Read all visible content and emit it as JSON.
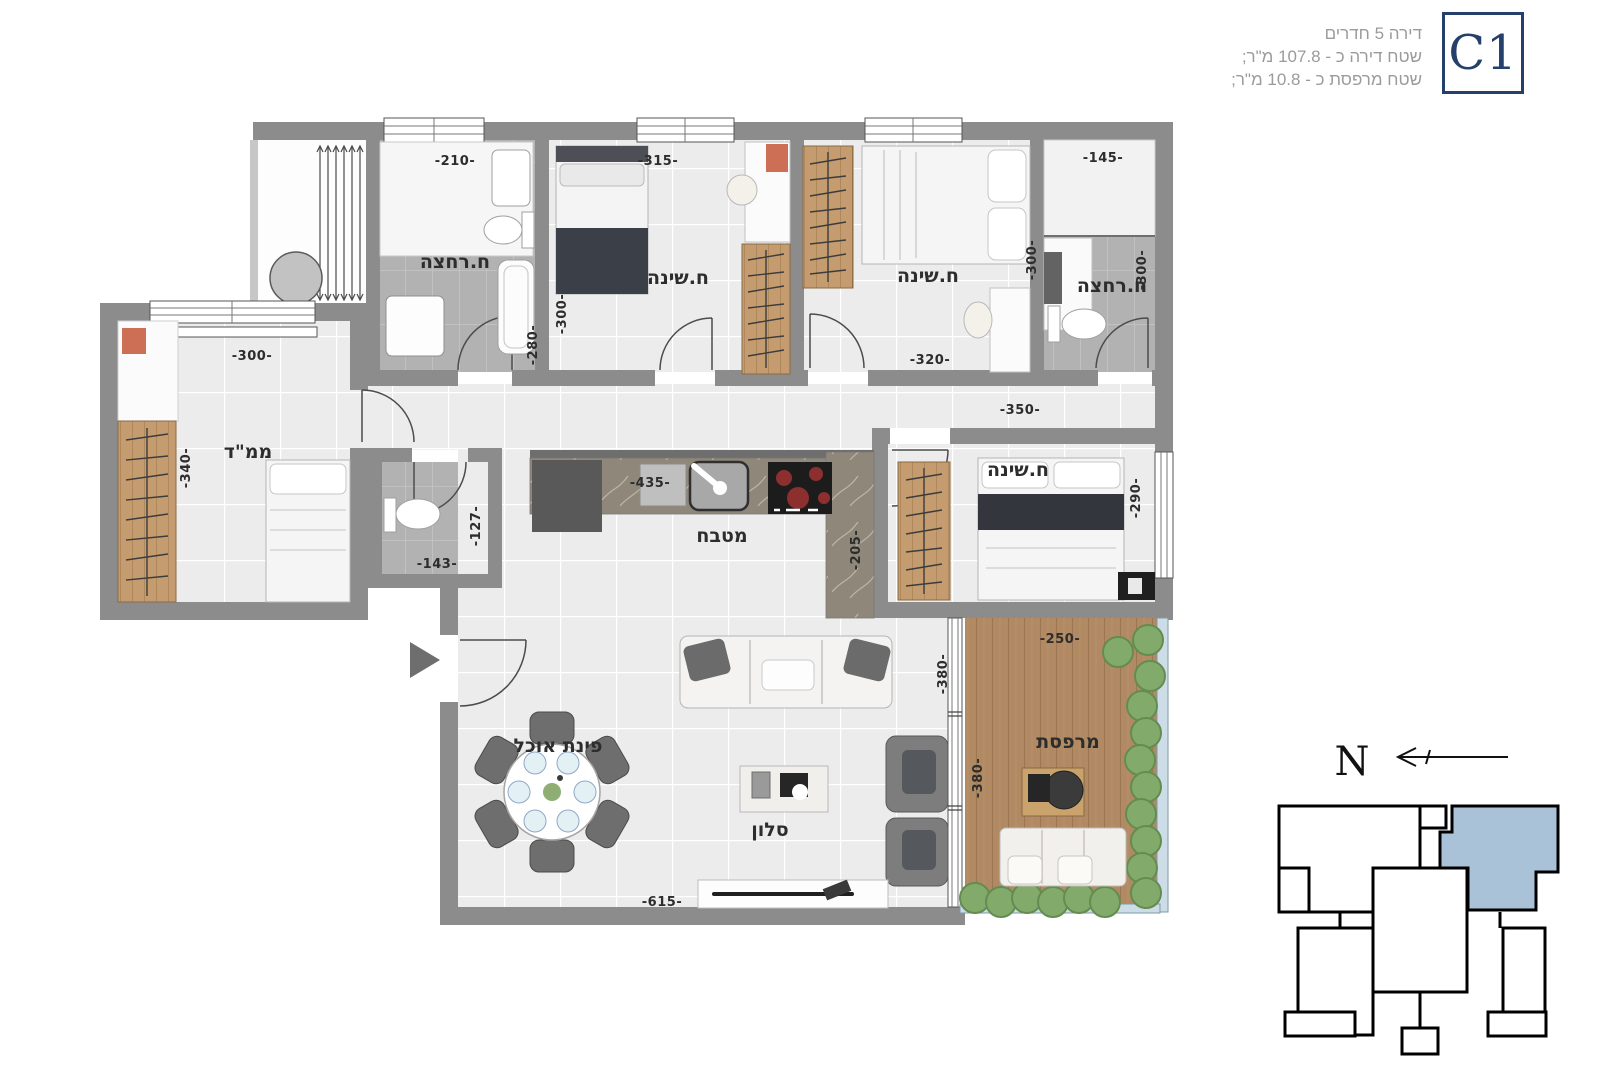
{
  "header": {
    "line1": "דירה 5 חדרים",
    "line2": "שטח דירה כ - 107.8 מ\"ר;",
    "line3": "שטח מרפסת כ - 10.8 מ\"ר;",
    "unit_code": "C1"
  },
  "rooms": {
    "bathroom_top_left": {
      "label": "ח.רחצה",
      "dim_width": "-210-",
      "dim_niche": "-280-"
    },
    "bedroom_top_1": {
      "label": "ח.שינה",
      "dim_width": "-315-",
      "dim_depth": "-300-"
    },
    "bedroom_top_2": {
      "label": "ח.שינה",
      "dim_width": "-320-",
      "dim_depth": "-300-"
    },
    "bathroom_top_right": {
      "label": "ח.רחצה",
      "dim_width": "-145-",
      "dim_depth": "-300-"
    },
    "mamad": {
      "label": "ממ\"ד",
      "dim_width": "-300-",
      "dim_depth": "-340-"
    },
    "wc": {
      "dim_width": "-143-",
      "dim_depth": "-127-"
    },
    "kitchen": {
      "label": "מטבח",
      "dim_width": "-435-",
      "dim_peninsula": "-205-"
    },
    "master_bedroom": {
      "label": "ח.שינה",
      "dim_width": "-350-",
      "dim_depth": "-290-"
    },
    "living_room": {
      "label": "סלון",
      "dim_width": "-615-",
      "dim_depth": "-380-"
    },
    "dining": {
      "label": "פינת אוכל"
    },
    "balcony": {
      "label": "מרפסת",
      "dim_width": "-250-",
      "dim_depth": "-380-"
    }
  },
  "compass": {
    "north_label": "N"
  },
  "colors": {
    "wall": "#8c8c8c",
    "tile_light": "#ececec",
    "tile_dark": "#b2b2b2",
    "wood": "#c49c6f",
    "deck": "#b18a63",
    "marble": "#8f8779",
    "greenery": "#82ab6b",
    "rail_glass": "#ccdde8",
    "key_highlight": "#aac2d8",
    "badge_navy": "#25406b",
    "header_gray": "#9b9b9b"
  }
}
